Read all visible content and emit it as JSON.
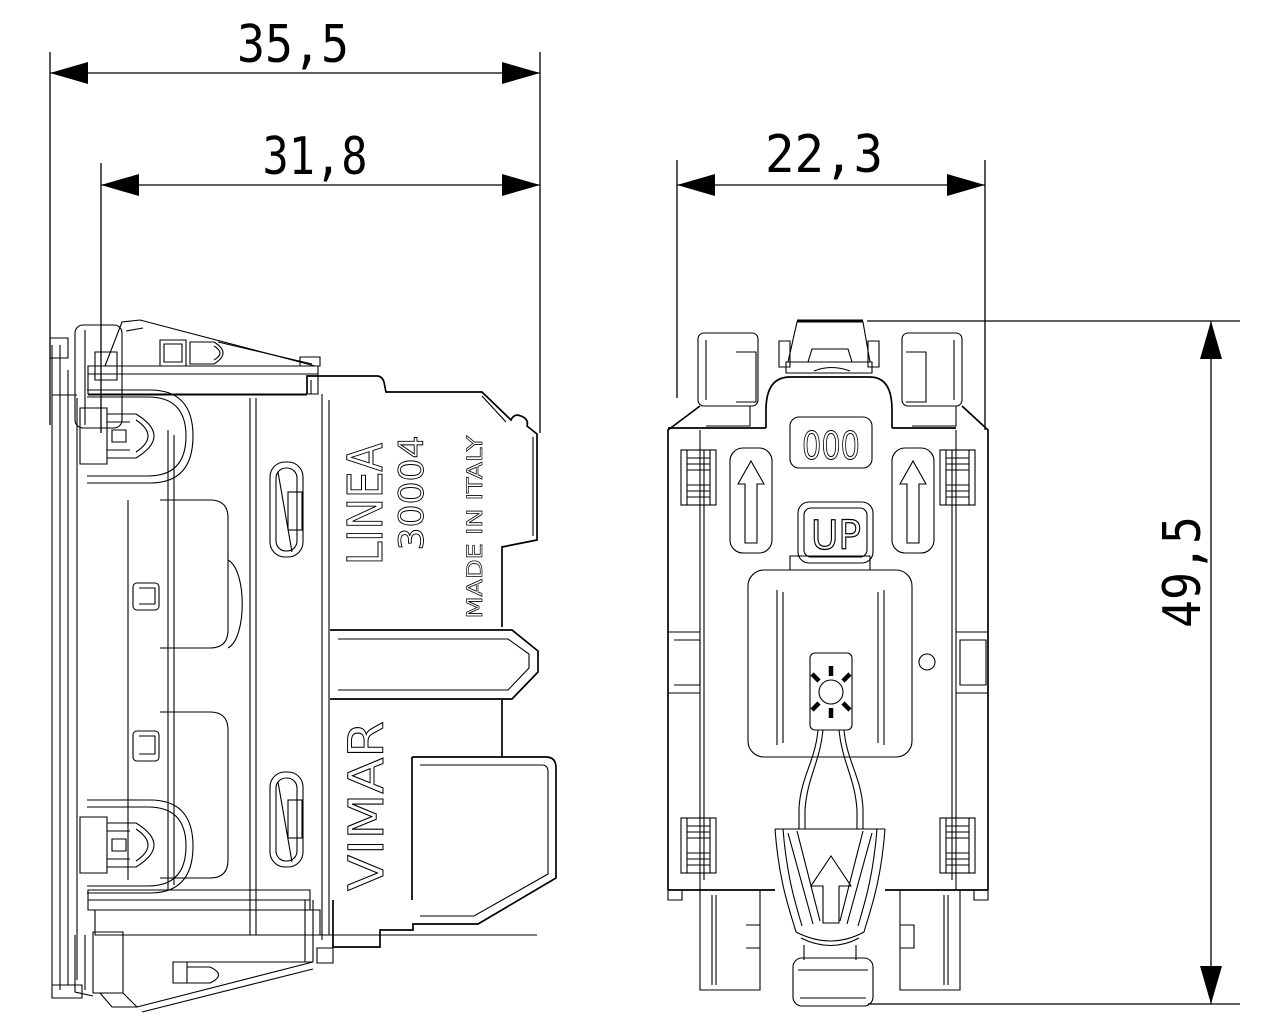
{
  "drawing": {
    "dimensions": {
      "overall_width": "35,5",
      "inner_width": "31,8",
      "depth": "22,3",
      "height": "49,5"
    },
    "side_view": {
      "brand_text": "LINEA",
      "model_text": "30004",
      "origin_text": "MADE IN ITALY",
      "maker_text": "VIMAR"
    },
    "rear_view": {
      "embossed_digits": "000",
      "up_label": "UP"
    },
    "colors": {
      "background": "#ffffff",
      "line": "#000000"
    }
  }
}
